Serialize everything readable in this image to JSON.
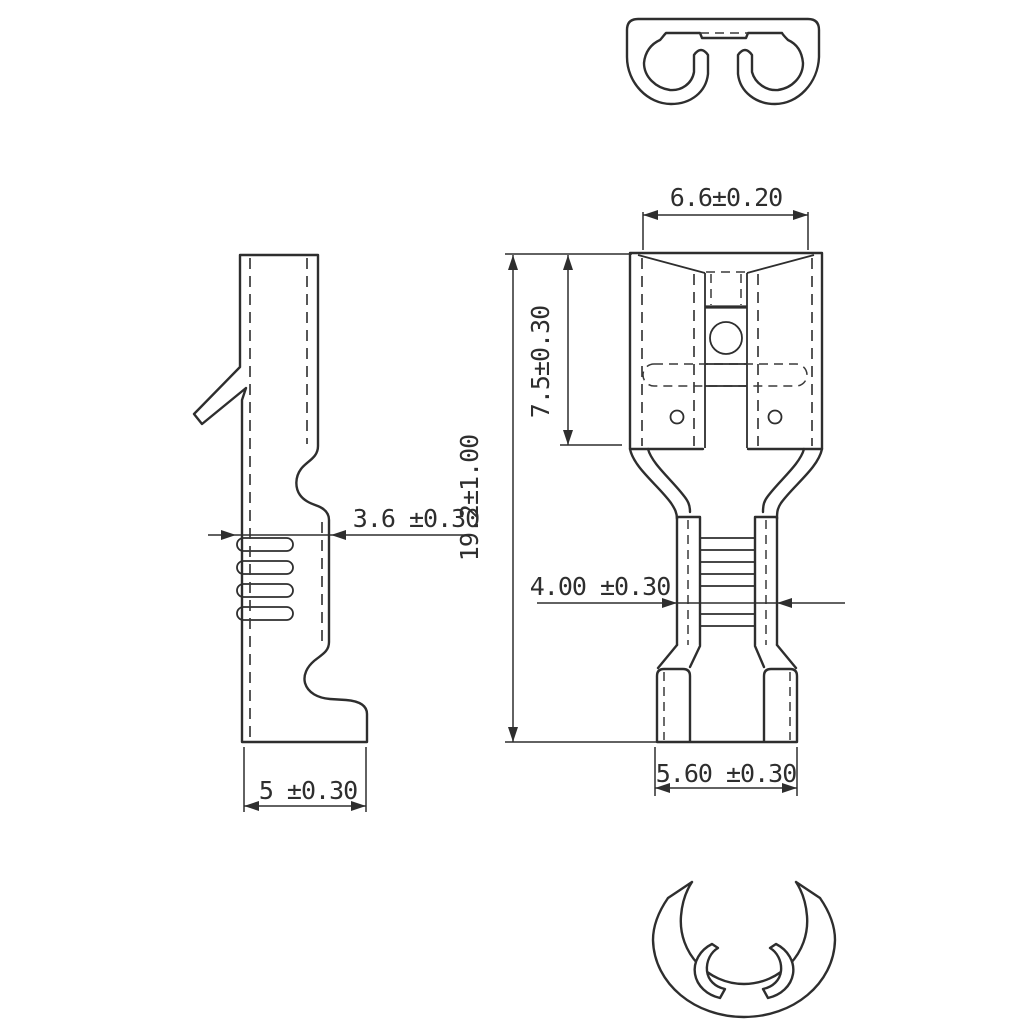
{
  "page": {
    "background_color": "#ffffff",
    "line_color": "#2e2e2e"
  },
  "dimensions": {
    "blade_width": "6.6±0.20",
    "contact_length": "7.5±0.30",
    "overall_length": "19.2±1.00",
    "side_crimp_thickness": "3.6 ±0.30",
    "wire_crimp_width": "4.00 ±0.30",
    "insulation_crimp_width": "5.60 ±0.30",
    "side_bottom_depth": "5 ±0.30"
  }
}
